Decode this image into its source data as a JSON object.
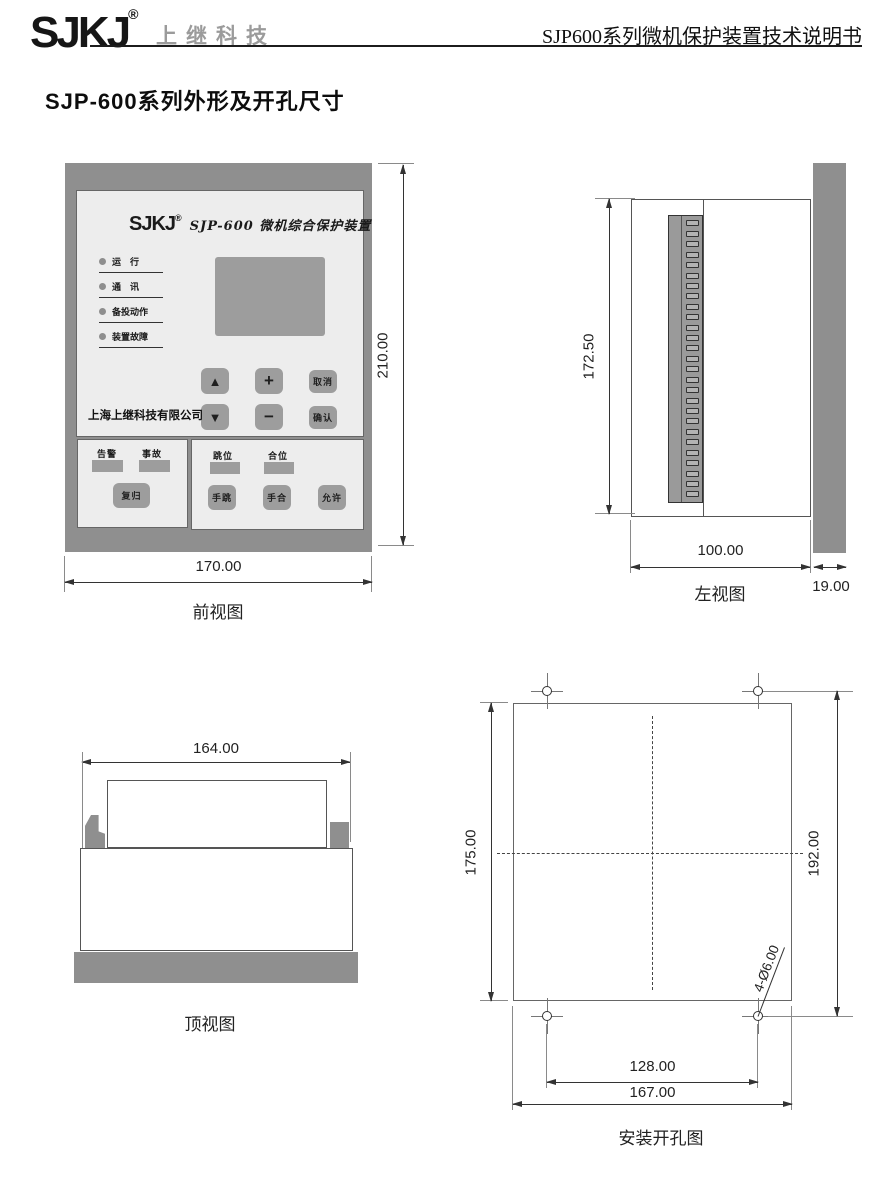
{
  "header": {
    "brand": "SJKJ",
    "reg": "®",
    "company": "上继科技",
    "doc_title": "SJP600系列微机保护装置技术说明书",
    "page_title": "SJP-600系列外形及开孔尺寸"
  },
  "front_view": {
    "caption": "前视图",
    "dims": {
      "width": "170.00",
      "height": "210.00"
    },
    "panel": {
      "brand": "SJKJ",
      "reg": "®",
      "model": "SJP-600 微机综合保护装置",
      "leds": [
        "运　行",
        "通　讯",
        "备投动作",
        "装置故障"
      ],
      "lcd": "lcd-screen",
      "company": "上海上继科技有限公司",
      "keys": {
        "up": "▲",
        "plus": "+",
        "cancel": "取消",
        "down": "▼",
        "minus": "−",
        "confirm": "确认"
      },
      "left_box": {
        "labels": [
          "告警",
          "事故"
        ],
        "button": "复归"
      },
      "right_box": {
        "labels": [
          "跳位",
          "合位"
        ],
        "buttons": [
          "手跳",
          "手合",
          "允许"
        ]
      }
    }
  },
  "left_view": {
    "caption": "左视图",
    "dims": {
      "height": "172.50",
      "depth": "100.00",
      "bezel": "19.00"
    },
    "terminal_count": 27
  },
  "top_view": {
    "caption": "顶视图",
    "dims": {
      "width": "164.00"
    }
  },
  "install_view": {
    "caption": "安装开孔图",
    "dims": {
      "cutout_height": "175.00",
      "hole_v_spacing": "192.00",
      "hole_h_spacing": "128.00",
      "cutout_width": "167.00",
      "hole_label": "4-Ø6.00"
    }
  },
  "colors": {
    "frame_gray": "#8f8f8f",
    "panel_gray": "#ededed",
    "control_gray": "#9d9d9d",
    "line_dark": "#333333"
  }
}
